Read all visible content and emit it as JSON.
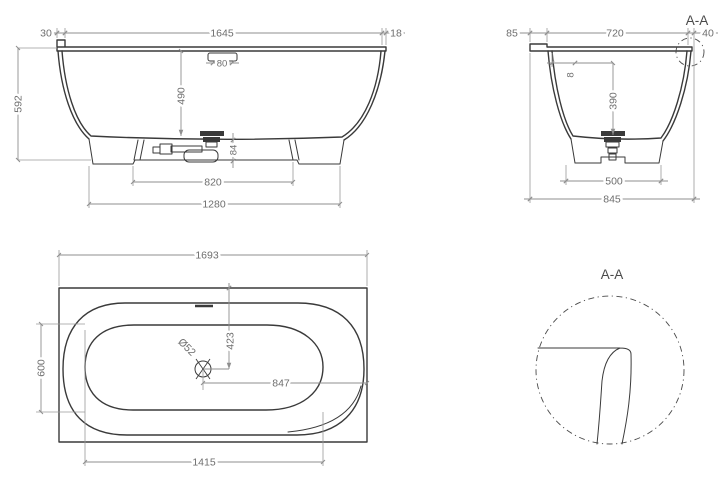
{
  "colors": {
    "background": "#ffffff",
    "outline_line": "#3a3a3a",
    "dimension_line": "#8f8f8f",
    "dimension_text": "#6e6e6e"
  },
  "front_view": {
    "dims": {
      "rim_left_step": "30",
      "rim_length": "1645",
      "rim_right_step": "18",
      "overall_height": "592",
      "basin_depth": "490",
      "overflow_width": "80",
      "drain_outlet_height": "84",
      "feet_spacing": "820",
      "base_length": "1280"
    }
  },
  "side_view": {
    "section_label": "A-A",
    "dims": {
      "rim_left_overhang": "85",
      "rim_width": "720",
      "rim_right_overhang": "40",
      "rim_lip": "8",
      "basin_depth": "390",
      "base_width": "500",
      "overall_width": "845"
    }
  },
  "top_view": {
    "dims": {
      "overall_length": "1693",
      "basin_width": "600",
      "drain_to_back_edge": "423",
      "drain_diameter": "Ø52",
      "drain_to_right_edge": "847",
      "basin_length": "1415"
    }
  },
  "detail_view": {
    "label": "A-A"
  }
}
